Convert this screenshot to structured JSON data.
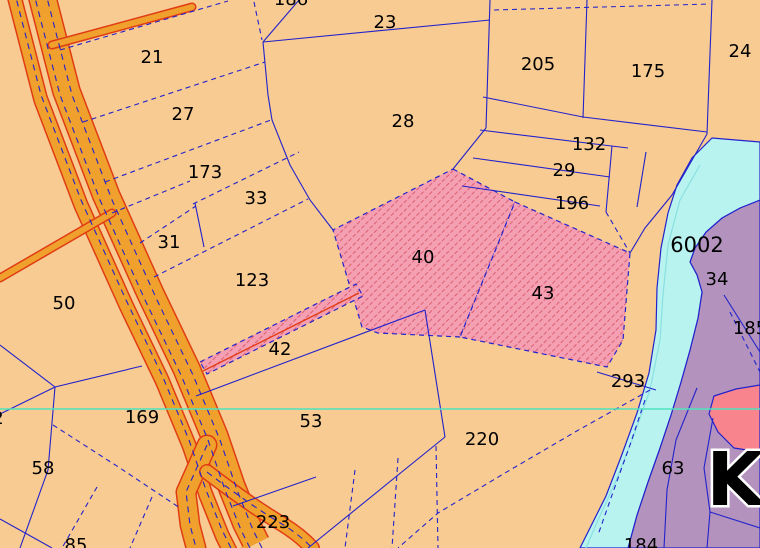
{
  "map": {
    "title": "Cadastral parcel map view",
    "type": "cadastral-parcel-map",
    "colors": {
      "parcel_fill": "#f8cb92",
      "boundary": "#2222cc",
      "road_fill": "#f0a02c",
      "road_edge": "#e03c14",
      "highlight_fill": "#f49fb2",
      "hatch_stroke": "#dd5f72",
      "river": "#b8f3f0",
      "river_inner": "#8ae0e0",
      "zone_purple": "#b393bd",
      "zone_pink": "#f8858e",
      "gridline": "#4fe3bd",
      "label": "#000000"
    },
    "gridline_y": 409,
    "river_label": "6002",
    "place_label": "K",
    "labels": [
      {
        "t": "186",
        "x": 291,
        "y": 5
      },
      {
        "t": "21",
        "x": 152,
        "y": 63
      },
      {
        "t": "23",
        "x": 385,
        "y": 28
      },
      {
        "t": "205",
        "x": 538,
        "y": 70
      },
      {
        "t": "175",
        "x": 648,
        "y": 77
      },
      {
        "t": "24",
        "x": 740,
        "y": 57
      },
      {
        "t": "27",
        "x": 183,
        "y": 120
      },
      {
        "t": "28",
        "x": 403,
        "y": 127
      },
      {
        "t": "132",
        "x": 589,
        "y": 150
      },
      {
        "t": "173",
        "x": 205,
        "y": 178
      },
      {
        "t": "29",
        "x": 564,
        "y": 176
      },
      {
        "t": "33",
        "x": 256,
        "y": 204
      },
      {
        "t": "196",
        "x": 572,
        "y": 209
      },
      {
        "t": "31",
        "x": 169,
        "y": 248
      },
      {
        "t": "6002",
        "x": 697,
        "y": 252,
        "s": 21
      },
      {
        "t": "40",
        "x": 423,
        "y": 263
      },
      {
        "t": "34",
        "x": 717,
        "y": 285
      },
      {
        "t": "123",
        "x": 252,
        "y": 286
      },
      {
        "t": "50",
        "x": 64,
        "y": 309
      },
      {
        "t": "43",
        "x": 543,
        "y": 299
      },
      {
        "t": "185",
        "x": 750,
        "y": 334
      },
      {
        "t": "42",
        "x": 280,
        "y": 355
      },
      {
        "t": "293",
        "x": 628,
        "y": 387
      },
      {
        "t": "169",
        "x": 142,
        "y": 423
      },
      {
        "t": "2",
        "x": -2,
        "y": 424
      },
      {
        "t": "53",
        "x": 311,
        "y": 427
      },
      {
        "t": "220",
        "x": 482,
        "y": 445
      },
      {
        "t": "58",
        "x": 43,
        "y": 474
      },
      {
        "t": "63",
        "x": 673,
        "y": 474
      },
      {
        "t": "K",
        "x": 735,
        "y": 505,
        "s": 74,
        "h": true
      },
      {
        "t": "223",
        "x": 273,
        "y": 528
      },
      {
        "t": "85",
        "x": 76,
        "y": 551
      },
      {
        "t": "184",
        "x": 641,
        "y": 551
      }
    ]
  }
}
